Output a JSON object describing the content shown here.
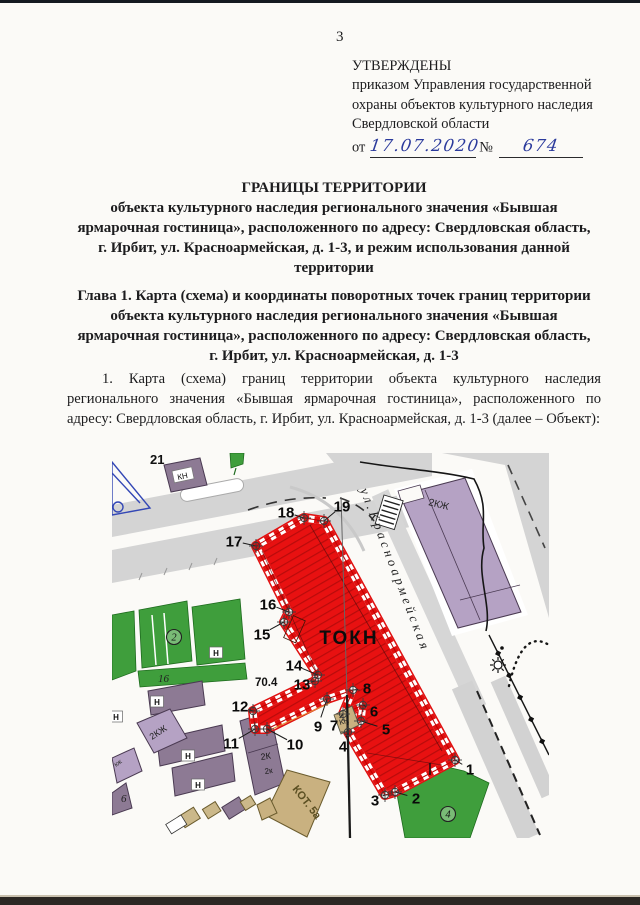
{
  "page_number": "3",
  "approval_block": {
    "status": "УТВЕРЖДЕНЫ",
    "lines": [
      "приказом Управления государственной",
      "охраны объектов культурного наследия",
      "Свердловской области"
    ],
    "date_label": "от",
    "date_handwritten": "17.07.2020",
    "number_label": "№",
    "number_handwritten": "674"
  },
  "title_block": {
    "heading": "ГРАНИЦЫ ТЕРРИТОРИИ",
    "lines": [
      "объекта культурного наследия регионального значения «Бывшая",
      "ярмарочная гостиница», расположенного по адресу: Свердловская область,",
      "г. Ирбит, ул. Красноармейская, д. 1-3, и режим использования данной",
      "территории"
    ]
  },
  "chapter_block": {
    "lines": [
      "Глава 1. Карта (схема) и координаты поворотных точек границ территории",
      "объекта культурного наследия регионального значения «Бывшая",
      "ярмарочная гостиница», расположенного по адресу: Свердловская область,",
      "г. Ирбит, ул. Красноармейская, д. 1-3"
    ]
  },
  "paragraph_1": "1. Карта (схема) границ территории объекта культурного наследия регионального значения «Бывшая ярмарочная гостиница», расположенного по адресу: Свердловская область, г. Ирбит, ул. Красноармейская, д. 1-3 (далее – Объект):",
  "map": {
    "territory_label": "ТОКН",
    "street_name": "ул.Красноармейская",
    "elevation_mark": "70.4",
    "colors": {
      "territory_red": "#e81111",
      "hatch_red": "#b80b0b",
      "green": "#3f9e3c",
      "lilac": "#b5a2c4",
      "mauve": "#8d7a94",
      "tan": "#c9b180",
      "road_grey": "#d4d4d4",
      "ink_blue": "#2b3a9c"
    },
    "points": [
      {
        "n": "1",
        "lx": 358,
        "ly": 316,
        "ax": 343,
        "ay": 307
      },
      {
        "n": "2",
        "lx": 304,
        "ly": 345,
        "ax": 283,
        "ay": 339
      },
      {
        "n": "3",
        "lx": 263,
        "ly": 347,
        "ax": 273,
        "ay": 342
      },
      {
        "n": "4",
        "lx": 231,
        "ly": 293,
        "ax": 236,
        "ay": 279
      },
      {
        "n": "5",
        "lx": 274,
        "ly": 276,
        "ax": 249,
        "ay": 268
      },
      {
        "n": "6",
        "lx": 262,
        "ly": 258,
        "ax": 251,
        "ay": 252
      },
      {
        "n": "7",
        "lx": 222,
        "ly": 272,
        "ax": 231,
        "ay": 261
      },
      {
        "n": "8",
        "lx": 255,
        "ly": 235,
        "ax": 241,
        "ay": 237
      },
      {
        "n": "9",
        "lx": 206,
        "ly": 273,
        "ax": 215,
        "ay": 246
      },
      {
        "n": "10",
        "lx": 183,
        "ly": 291,
        "ax": 155,
        "ay": 276
      },
      {
        "n": "11",
        "lx": 119,
        "ly": 290,
        "ax": 143,
        "ay": 276
      },
      {
        "n": "12",
        "lx": 128,
        "ly": 253,
        "ax": 141,
        "ay": 258
      },
      {
        "n": "13",
        "lx": 190,
        "ly": 231,
        "ax": 203,
        "ay": 228
      },
      {
        "n": "14",
        "lx": 182,
        "ly": 212,
        "ax": 206,
        "ay": 222
      },
      {
        "n": "15",
        "lx": 150,
        "ly": 181,
        "ax": 172,
        "ay": 169
      },
      {
        "n": "16",
        "lx": 156,
        "ly": 151,
        "ax": 177,
        "ay": 159
      },
      {
        "n": "17",
        "lx": 122,
        "ly": 88,
        "ax": 144,
        "ay": 93
      },
      {
        "n": "18",
        "lx": 174,
        "ly": 59,
        "ax": 192,
        "ay": 65
      },
      {
        "n": "19",
        "lx": 230,
        "ly": 53,
        "ax": 212,
        "ay": 68
      }
    ],
    "labels": [
      {
        "t": "ул.Красноармейская",
        "x": 248,
        "y": 37,
        "r": 69,
        "s": 13,
        "i": true,
        "ls": 3.5,
        "fill": "#222222",
        "name": "street-name-label"
      },
      {
        "t": "ТОКН",
        "x": 237,
        "y": 191,
        "s": 19,
        "w": "bold",
        "ls": 2,
        "anchor": "middle",
        "fill": "#0c0c0c",
        "name": "territory-label"
      },
      {
        "t": "70.4",
        "x": 143,
        "y": 233,
        "s": 11.5,
        "w": "bold",
        "fill": "#111111",
        "name": "elevation-label"
      },
      {
        "t": "21",
        "x": 38,
        "y": 11,
        "s": 13,
        "w": "bold",
        "fill": "#111111",
        "name": "parcel-21-label"
      },
      {
        "t": "2КЖ",
        "x": 316,
        "y": 52,
        "r": 14,
        "s": 10,
        "fill": "#242424",
        "name": "building-2kzh-label"
      },
      {
        "t": "КН",
        "x": 66,
        "y": 27,
        "r": -12,
        "s": 8,
        "fill": "#111111",
        "chip": true,
        "name": "building-kn-top-label"
      },
      {
        "t": "2КЖ",
        "x": 40,
        "y": 287,
        "r": -33,
        "s": 9,
        "fill": "#222222",
        "name": "building-2kzh-strip-label"
      },
      {
        "t": "2К",
        "x": 149,
        "y": 307,
        "r": -8,
        "s": 9,
        "fill": "#1a1a1a",
        "name": "building-2k-label"
      },
      {
        "t": "2к",
        "x": 153,
        "y": 321,
        "r": -8,
        "s": 8,
        "fill": "#1a1a1a",
        "name": "building-2k-small-label"
      },
      {
        "t": "КОТ. 5а",
        "x": 180,
        "y": 336,
        "r": 52,
        "s": 11,
        "w": "bold",
        "fill": "#5b4f22",
        "name": "boiler-house-label"
      },
      {
        "t": "КН",
        "x": 228,
        "y": 272,
        "r": -15,
        "s": 7.5,
        "fill": "#222222",
        "name": "building-kn-center-label"
      },
      {
        "t": "16",
        "x": 46,
        "y": 229,
        "s": 11,
        "i": true,
        "fill": "#222222",
        "name": "parcel-16-label"
      },
      {
        "t": "6",
        "x": 9,
        "y": 349,
        "s": 11,
        "i": true,
        "fill": "#222222",
        "name": "parcel-6-label"
      },
      {
        "t": "кж",
        "x": 4,
        "y": 314,
        "r": -35,
        "s": 7,
        "fill": "#333333",
        "name": "kzh-label"
      }
    ],
    "n_chips": [
      {
        "t": "Н",
        "x": 45,
        "y": 251
      },
      {
        "t": "Н",
        "x": 76,
        "y": 305
      },
      {
        "t": "Н",
        "x": 86,
        "y": 334
      },
      {
        "t": "Н",
        "x": 104,
        "y": 202
      },
      {
        "t": "Н",
        "x": 4,
        "y": 266
      }
    ],
    "circled": [
      {
        "t": "2",
        "x": 62,
        "y": 184
      },
      {
        "t": "4",
        "x": 336,
        "y": 361
      }
    ]
  }
}
